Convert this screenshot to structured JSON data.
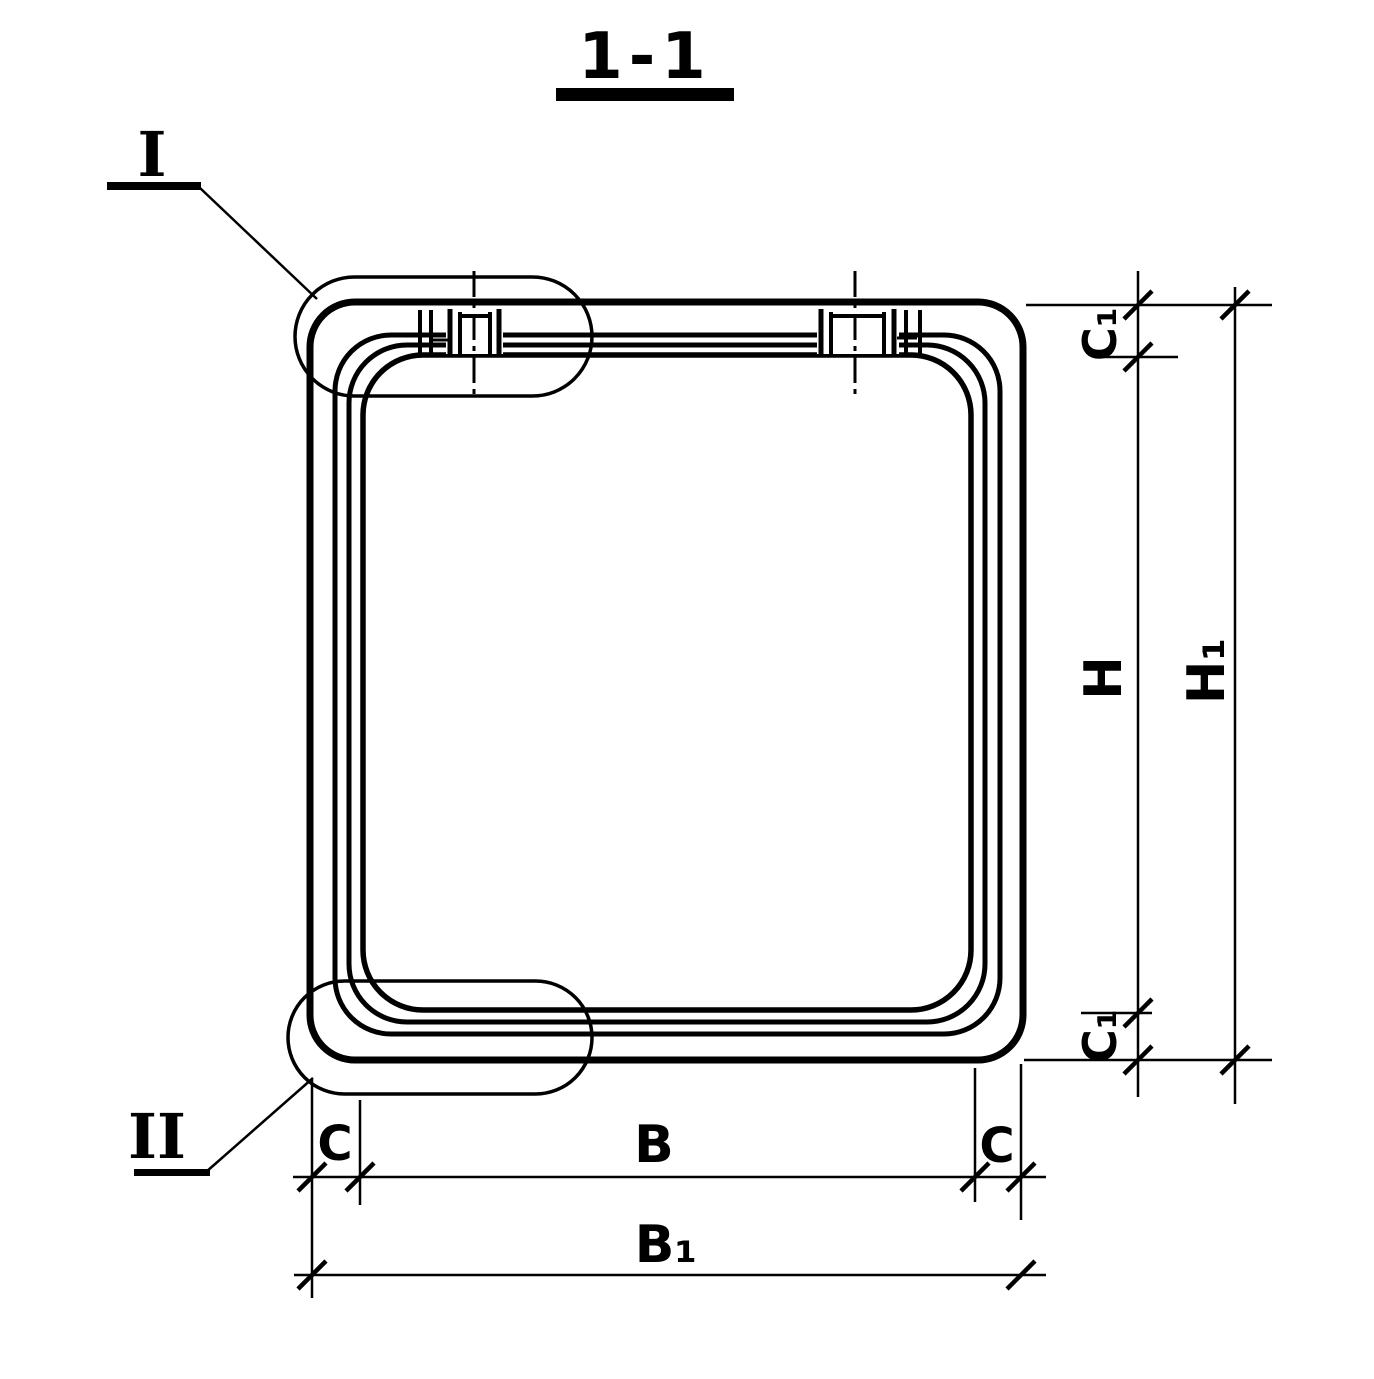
{
  "colors": {
    "ink": "#000000",
    "paper": "#ffffff"
  },
  "title": {
    "text": "1-1"
  },
  "details": {
    "top_left": "I",
    "bottom_left": "II"
  },
  "dimensions": {
    "inner_height": "H",
    "outer_height": "H₁",
    "inner_width": "B",
    "outer_width": "B₁",
    "wall_left": "C",
    "wall_right": "C",
    "wall_top": "C₁",
    "wall_bottom": "C₁"
  }
}
